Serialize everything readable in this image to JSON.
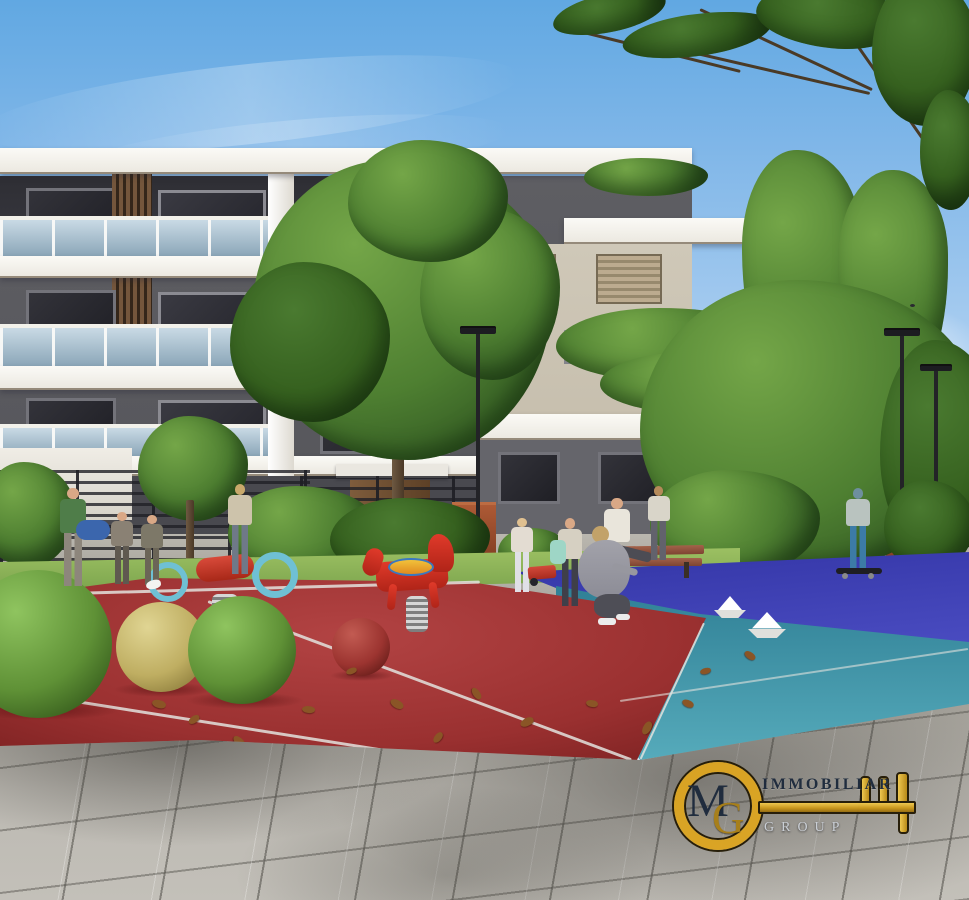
{
  "watermark": {
    "monogram_m": "M",
    "monogram_g": "G",
    "line1": "IMMOBILIAR",
    "line2": "GROUP",
    "colors": {
      "gold": "#dca522",
      "gold_dark": "#8a6410",
      "outline": "#241b06",
      "text_dark": "#1d2a3c",
      "text_light": "#ccd1d8"
    }
  },
  "scene": {
    "type": "exterior architectural rendering",
    "subject": "modern three-storey apartment complex with landscaped courtyard and children's playground",
    "palette": {
      "sky_top": "#61a8e2",
      "sky_mid": "#a9cdf0",
      "sky_horizon": "#e2edf8",
      "slab": "#f3f2ec",
      "wall_dark": "#57575c",
      "wall_recess": "#3a3a41",
      "wall_medium": "#66666c",
      "beige_wall": "#c7bfae",
      "wood_dark": "#6b4f36",
      "glass_light": "#b4c9d7",
      "foliage_dark": "#2d5220",
      "foliage": "#4e7f31",
      "foliage_light": "#74a648",
      "lawn": "#84ad55",
      "court_red": "#a23434",
      "court_teal": "#3f93a6",
      "court_blue": "#3a3bae",
      "court_line": "#e3e3de",
      "paving": "#b7b4ad",
      "paving_dark": "#84827c",
      "ball_green": "#5f9136",
      "ball_yellow": "#bfae62",
      "ball_red": "#9c3430",
      "planter_rust": "#9c4c2c",
      "lamp_black": "#232327",
      "trunk": "#5d4833",
      "skin": "#d9a886"
    },
    "objects": [
      "apartment-building",
      "roof-slab",
      "floor-slab",
      "glass-balcony-railing",
      "wood-slat-screen",
      "roller-shutter-window",
      "hanging-terrace-plants",
      "street-lamp",
      "tree",
      "bush",
      "birch-trunk",
      "corten-planter",
      "metal-fence",
      "garden-bench",
      "walkway",
      "lawn-strip",
      "play-court-red",
      "play-court-teal",
      "play-court-blue",
      "court-line",
      "paving-tiles",
      "distant-house",
      "bird"
    ],
    "people": [
      "man-with-duffel-bag",
      "child-walking-1",
      "child-walking-2",
      "woman-walking-left",
      "girl-with-toy-cart",
      "child-with-backpack",
      "woman-crouching",
      "man-sitting-on-bench",
      "woman-behind-bench",
      "boy-on-skateboard"
    ],
    "toys": [
      "spring-rider-scooter",
      "spring-rider-horse",
      "play-ball-green-large",
      "play-ball-green",
      "play-ball-yellow",
      "play-ball-red",
      "paper-boat-1",
      "paper-boat-2",
      "paper-dove"
    ]
  }
}
